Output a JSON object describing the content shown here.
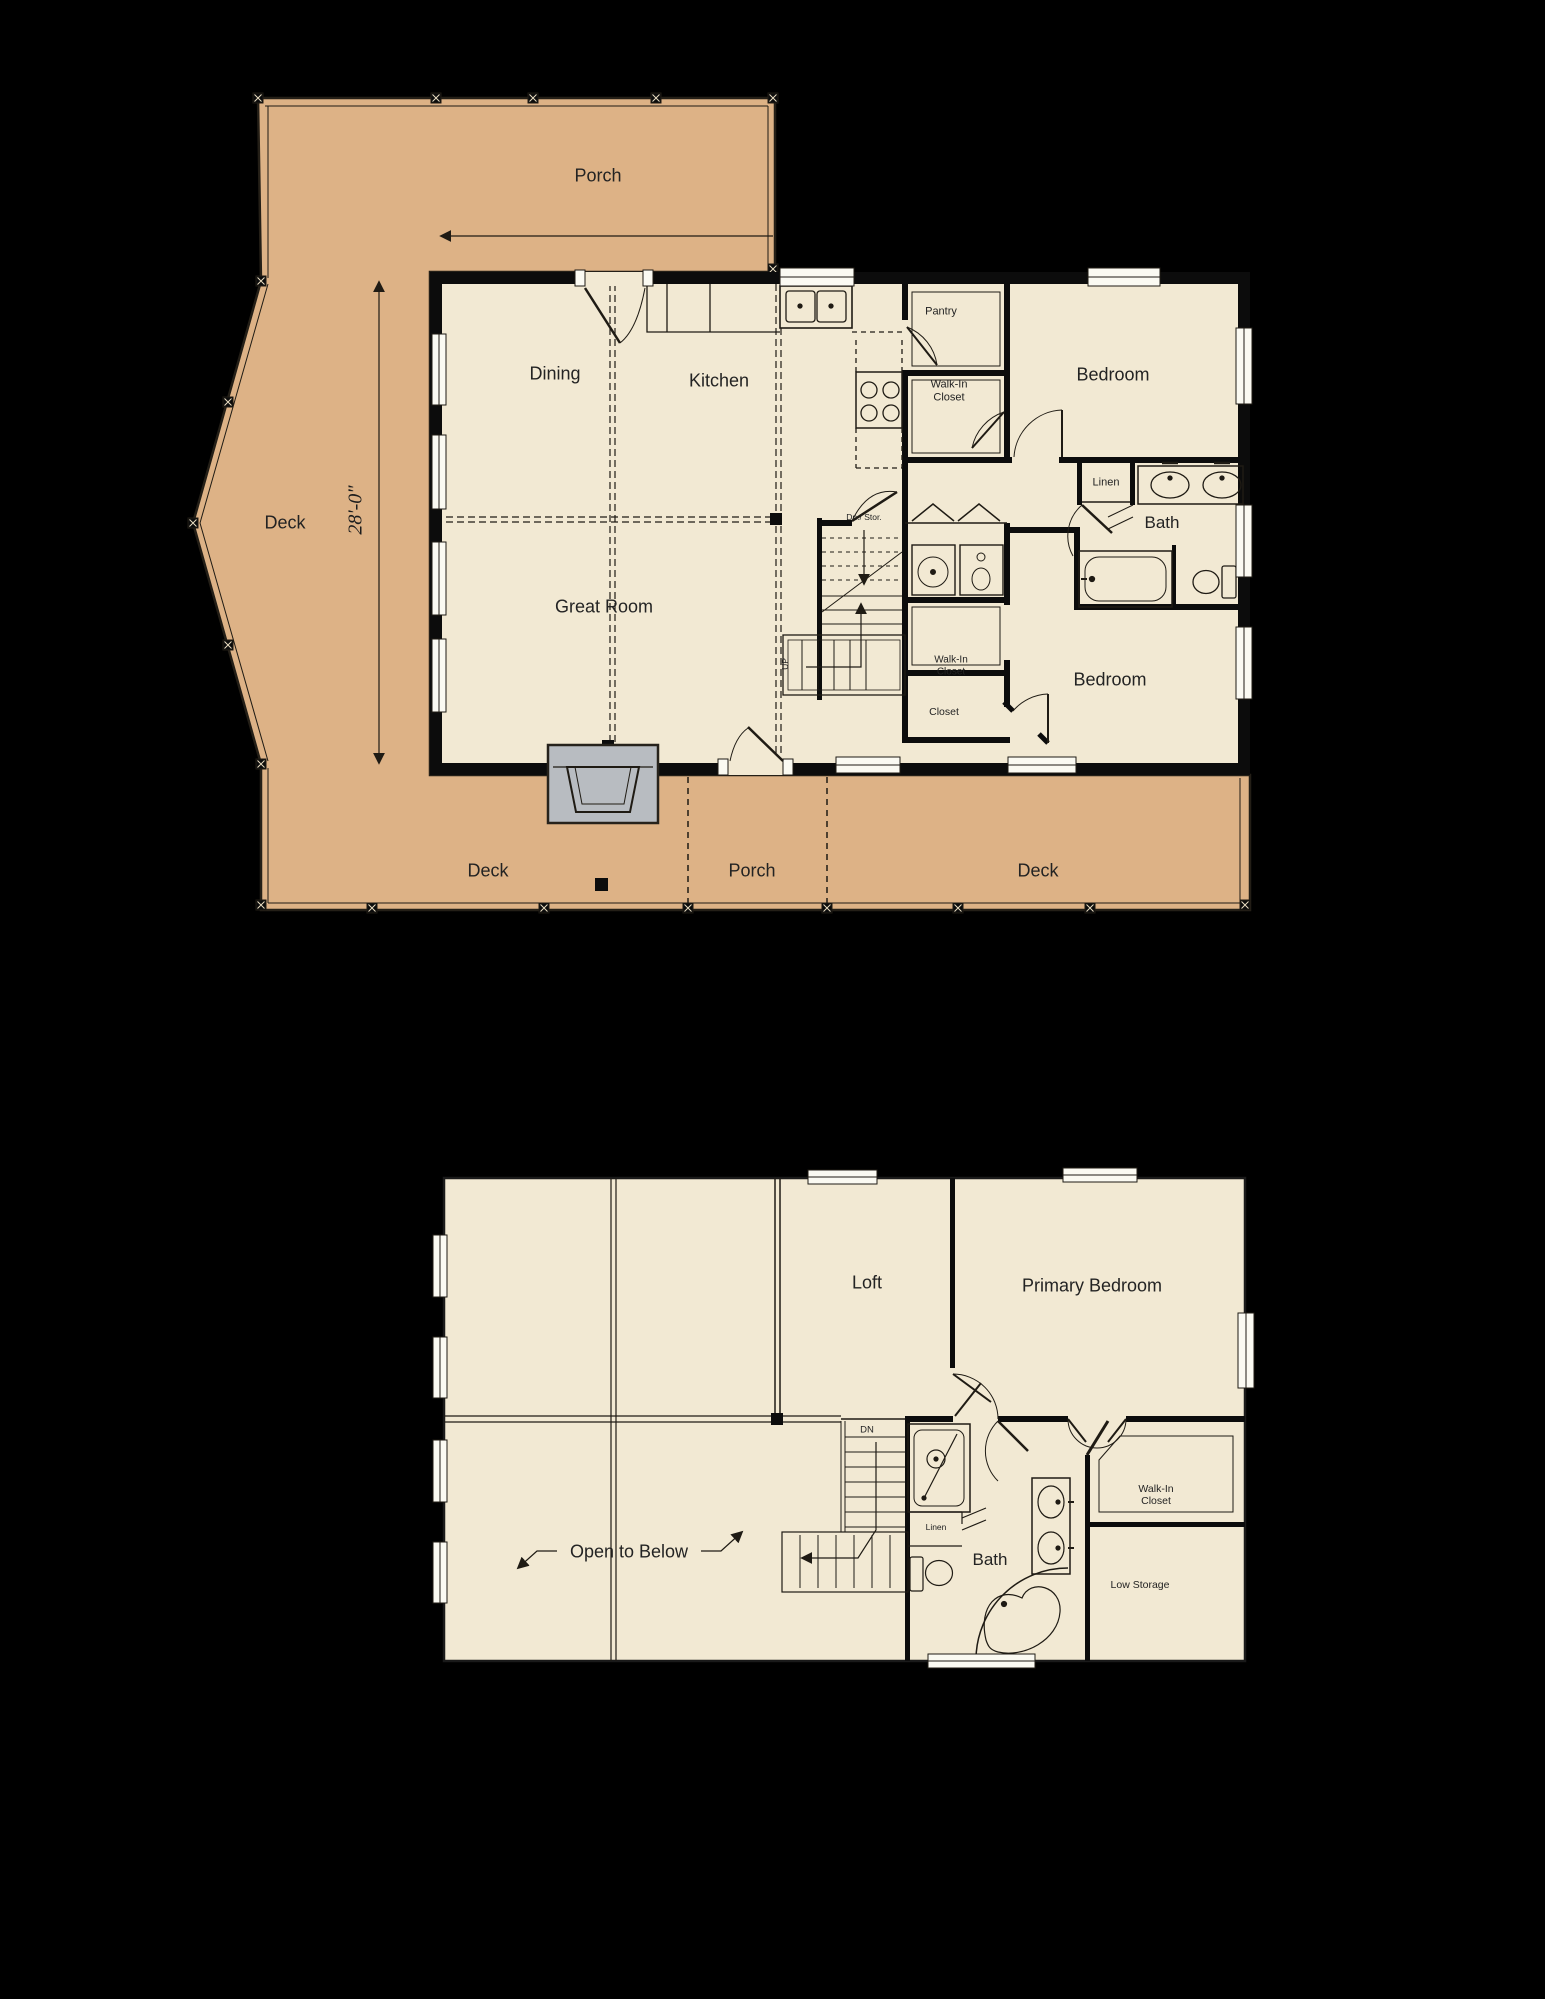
{
  "colors": {
    "background": "#000000",
    "deck_porch": "#ddb286",
    "interior": "#f2e9d3",
    "wall": "#0c0c0c",
    "line": "#1f1b14",
    "fireplace_gray": "#b8bcc1",
    "window_white": "#fbfaf2"
  },
  "floor1": {
    "dimension": "28'-0\"",
    "rooms": {
      "porch_top": "Porch",
      "deck_left": "Deck",
      "dining": "Dining",
      "kitchen": "Kitchen",
      "pantry": "Pantry",
      "walk_in_closet_top": "Walk-In Closet",
      "bedroom_top": "Bedroom",
      "linen": "Linen",
      "bath": "Bath",
      "great_room": "Great Room",
      "stairs_down": "Dn./ Stor.",
      "stairs_up": "UP",
      "walk_in_closet_bottom": "Walk-In Closet",
      "closet": "Closet",
      "bedroom_bottom": "Bedroom",
      "deck_bottom_left": "Deck",
      "porch_bottom": "Porch",
      "deck_bottom_right": "Deck"
    }
  },
  "floor2": {
    "rooms": {
      "loft": "Loft",
      "primary_bedroom": "Primary Bedroom",
      "open_to_below": "Open to Below",
      "stairs_down": "DN",
      "linen": "Linen",
      "bath": "Bath",
      "walk_in_closet": "Walk-In Closet",
      "low_storage": "Low Storage"
    }
  }
}
